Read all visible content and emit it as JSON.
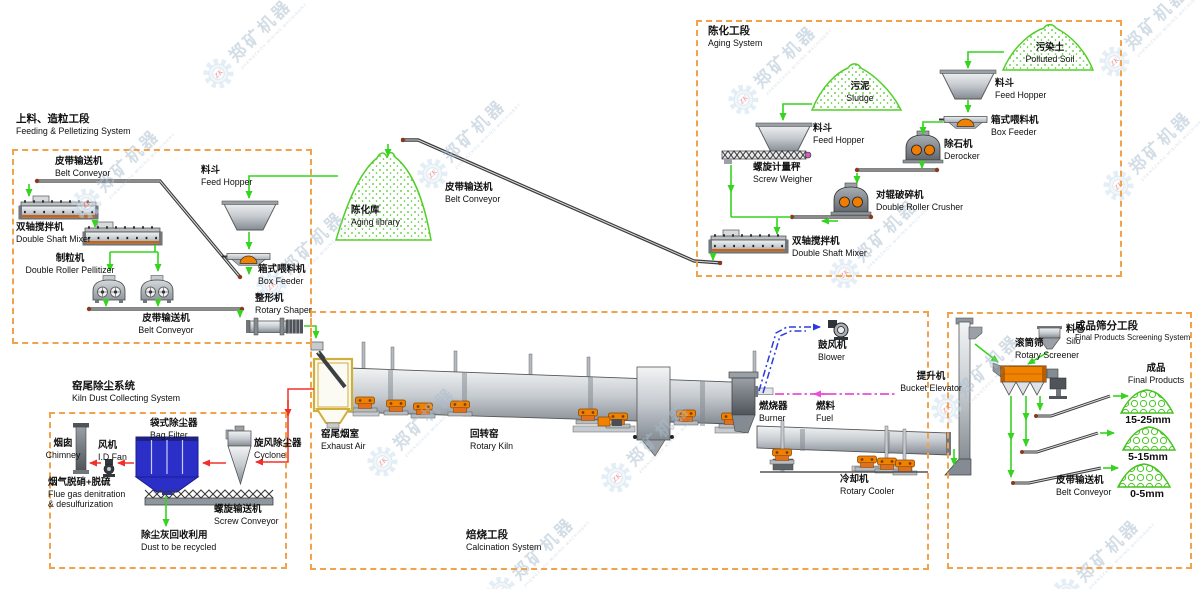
{
  "page": {
    "width": 1200,
    "height": 589,
    "background": "#ffffff"
  },
  "colors": {
    "section_dash": "#f2a24b",
    "flow_green": "#35d41f",
    "flow_red": "#f2302a",
    "flow_blue": "#2b3be0",
    "flow_magenta": "#ea4fd5",
    "bag_filter_blue": "#2b2fc7",
    "equipment_orange": "#f08200",
    "screener_orange": "#f08200"
  },
  "watermark": {
    "zh": "郑矿机器",
    "en": "ZHENGZHOU MINING MACHINERY",
    "logo": "ZK"
  },
  "watermarks": [
    [
      252,
      40
    ],
    [
      777,
      66
    ],
    [
      1148,
      28
    ],
    [
      120,
      170
    ],
    [
      466,
      140
    ],
    [
      1152,
      152
    ],
    [
      305,
      252
    ],
    [
      878,
      240
    ],
    [
      416,
      428
    ],
    [
      650,
      444
    ],
    [
      980,
      375
    ],
    [
      535,
      558
    ],
    [
      1100,
      560
    ]
  ],
  "sections": [
    {
      "id": "feeding",
      "zh": "上料、造粒工段",
      "en": "Feeding & Pelletizing System",
      "box": [
        12,
        149,
        296,
        191
      ],
      "title_pos": [
        16,
        113
      ]
    },
    {
      "id": "aging",
      "zh": "陈化工段",
      "en": "Aging System",
      "box": [
        696,
        20,
        422,
        253
      ],
      "title_pos": [
        708,
        25
      ]
    },
    {
      "id": "kiln-dust",
      "zh": "窑尾除尘系统",
      "en": "Kiln Dust Collecting System",
      "box": [
        49,
        412,
        234,
        153
      ],
      "title_pos": [
        72,
        380
      ]
    },
    {
      "id": "calcination",
      "zh": "焙烧工段",
      "en": "Calcination System",
      "box": [
        310,
        311,
        615,
        255
      ],
      "title_pos": [
        466,
        529
      ]
    },
    {
      "id": "screening",
      "zh": "成品筛分工段",
      "en": "Final Products Screening System",
      "box": [
        947,
        312,
        241,
        253
      ],
      "title_pos": [
        1075,
        320
      ],
      "small": true
    }
  ],
  "labels": [
    {
      "id": "belt-conveyor-1",
      "zh": "皮带输送机",
      "en": "Belt Conveyor",
      "x": 55,
      "y": 157
    },
    {
      "id": "feed-hopper-1",
      "zh": "料斗",
      "en": "Feed Hopper",
      "x": 201,
      "y": 166
    },
    {
      "id": "double-shaft-mixer-1",
      "zh": "双轴搅拌机",
      "en": "Double Shaft Mixer",
      "x": 16,
      "y": 223
    },
    {
      "id": "double-roller-pellitizer",
      "zh": "制粒机",
      "en": "Double Roller Pellitizer",
      "x": 14,
      "y": 254,
      "w": 112,
      "align": "center"
    },
    {
      "id": "box-feeder-1",
      "zh": "箱式喂料机",
      "en": "Box Feeder",
      "x": 258,
      "y": 265
    },
    {
      "id": "rotary-shaper",
      "zh": "整形机",
      "en": "Rotary Shaper",
      "x": 255,
      "y": 294
    },
    {
      "id": "belt-conveyor-2",
      "zh": "皮带输送机",
      "en": "Belt Conveyor",
      "x": 120,
      "y": 314,
      "w": 92,
      "align": "center"
    },
    {
      "id": "aging-library",
      "zh": "陈化库",
      "en": "Aging library",
      "x": 351,
      "y": 206
    },
    {
      "id": "belt-conveyor-3",
      "zh": "皮带输送机",
      "en": "Belt Conveyor",
      "x": 445,
      "y": 183
    },
    {
      "id": "polluted-soil",
      "zh": "污染土",
      "en": "Polluted Soil",
      "x": 1008,
      "y": 43,
      "w": 84,
      "align": "center"
    },
    {
      "id": "feed-hopper-3",
      "zh": "料斗",
      "en": "Feed Hopper",
      "x": 995,
      "y": 79
    },
    {
      "id": "box-feeder-2",
      "zh": "箱式喂料机",
      "en": "Box Feeder",
      "x": 991,
      "y": 116
    },
    {
      "id": "derocker",
      "zh": "除石机",
      "en": "Derocker",
      "x": 944,
      "y": 140
    },
    {
      "id": "double-roller-crusher",
      "zh": "对辊破碎机",
      "en": "Double Roller Crusher",
      "x": 876,
      "y": 191
    },
    {
      "id": "sludge",
      "zh": "污泥",
      "en": "Sludge",
      "x": 828,
      "y": 82,
      "w": 64,
      "align": "center"
    },
    {
      "id": "feed-hopper-2",
      "zh": "料斗",
      "en": "Feed Hopper",
      "x": 813,
      "y": 124
    },
    {
      "id": "screw-weigher",
      "zh": "螺旋计量秤",
      "en": "Screw Weigher",
      "x": 753,
      "y": 163
    },
    {
      "id": "double-shaft-mixer-2",
      "zh": "双轴搅拌机",
      "en": "Double Shaft Mixer",
      "x": 792,
      "y": 237
    },
    {
      "id": "chimney",
      "zh": "烟囱",
      "en": "Chimney",
      "x": 36,
      "y": 439,
      "w": 54,
      "align": "center"
    },
    {
      "id": "id-fan",
      "zh": "风机",
      "en": "I.D.Fan",
      "x": 98,
      "y": 441
    },
    {
      "id": "bag-filter",
      "zh": "袋式除尘器",
      "en": "Bag Filter",
      "x": 150,
      "y": 419
    },
    {
      "id": "cyclone",
      "zh": "旋风除尘器",
      "en": "Cyclone",
      "x": 254,
      "y": 439
    },
    {
      "id": "flue-gas",
      "zh": "烟气脱硝+脱硫",
      "en": "Flue gas denitration",
      "en2": "& desulfurization",
      "x": 48,
      "y": 478
    },
    {
      "id": "screw-conveyor",
      "zh": "螺旋输送机",
      "en": "Screw Conveyor",
      "x": 214,
      "y": 505
    },
    {
      "id": "dust-recycled",
      "zh": "除尘灰回收利用",
      "en": "Dust to be recycled",
      "x": 141,
      "y": 531
    },
    {
      "id": "exhaust-air",
      "zh": "窑尾烟室",
      "en": "Exhaust Air",
      "x": 321,
      "y": 430
    },
    {
      "id": "rotary-kiln",
      "zh": "回转窑",
      "en": "Rotary Kiln",
      "x": 470,
      "y": 430
    },
    {
      "id": "blower",
      "zh": "鼓风机",
      "en": "Blower",
      "x": 818,
      "y": 341
    },
    {
      "id": "burner",
      "zh": "燃烧器",
      "en": "Burner",
      "x": 759,
      "y": 402
    },
    {
      "id": "fuel",
      "zh": "燃料",
      "en": "Fuel",
      "x": 816,
      "y": 402
    },
    {
      "id": "bucket-elevator",
      "zh": "提升机",
      "en": "Bucket Elevator",
      "x": 896,
      "y": 372,
      "w": 70,
      "align": "center"
    },
    {
      "id": "rotary-cooler",
      "zh": "冷却机",
      "en": "Rotary Cooler",
      "x": 840,
      "y": 475
    },
    {
      "id": "silo",
      "zh": "料仓",
      "en": "Silo",
      "x": 1066,
      "y": 325
    },
    {
      "id": "rotary-screener",
      "zh": "滚筒筛",
      "en": "Rotary Screener",
      "x": 1015,
      "y": 339
    },
    {
      "id": "final-products",
      "zh": "成品",
      "en": "Final Products",
      "x": 1124,
      "y": 364,
      "w": 64,
      "align": "center"
    },
    {
      "id": "belt-conveyor-4",
      "zh": "皮带输送机",
      "en": "Belt Conveyor",
      "x": 1056,
      "y": 476
    },
    {
      "id": "size-15-25",
      "text": "15-25mm",
      "x": 1120,
      "y": 414,
      "w": 56,
      "align": "center"
    },
    {
      "id": "size-5-15",
      "text": "5-15mm",
      "x": 1122,
      "y": 451,
      "w": 52,
      "align": "center"
    },
    {
      "id": "size-0-5",
      "text": "0-5mm",
      "x": 1122,
      "y": 488,
      "w": 50,
      "align": "center"
    }
  ]
}
